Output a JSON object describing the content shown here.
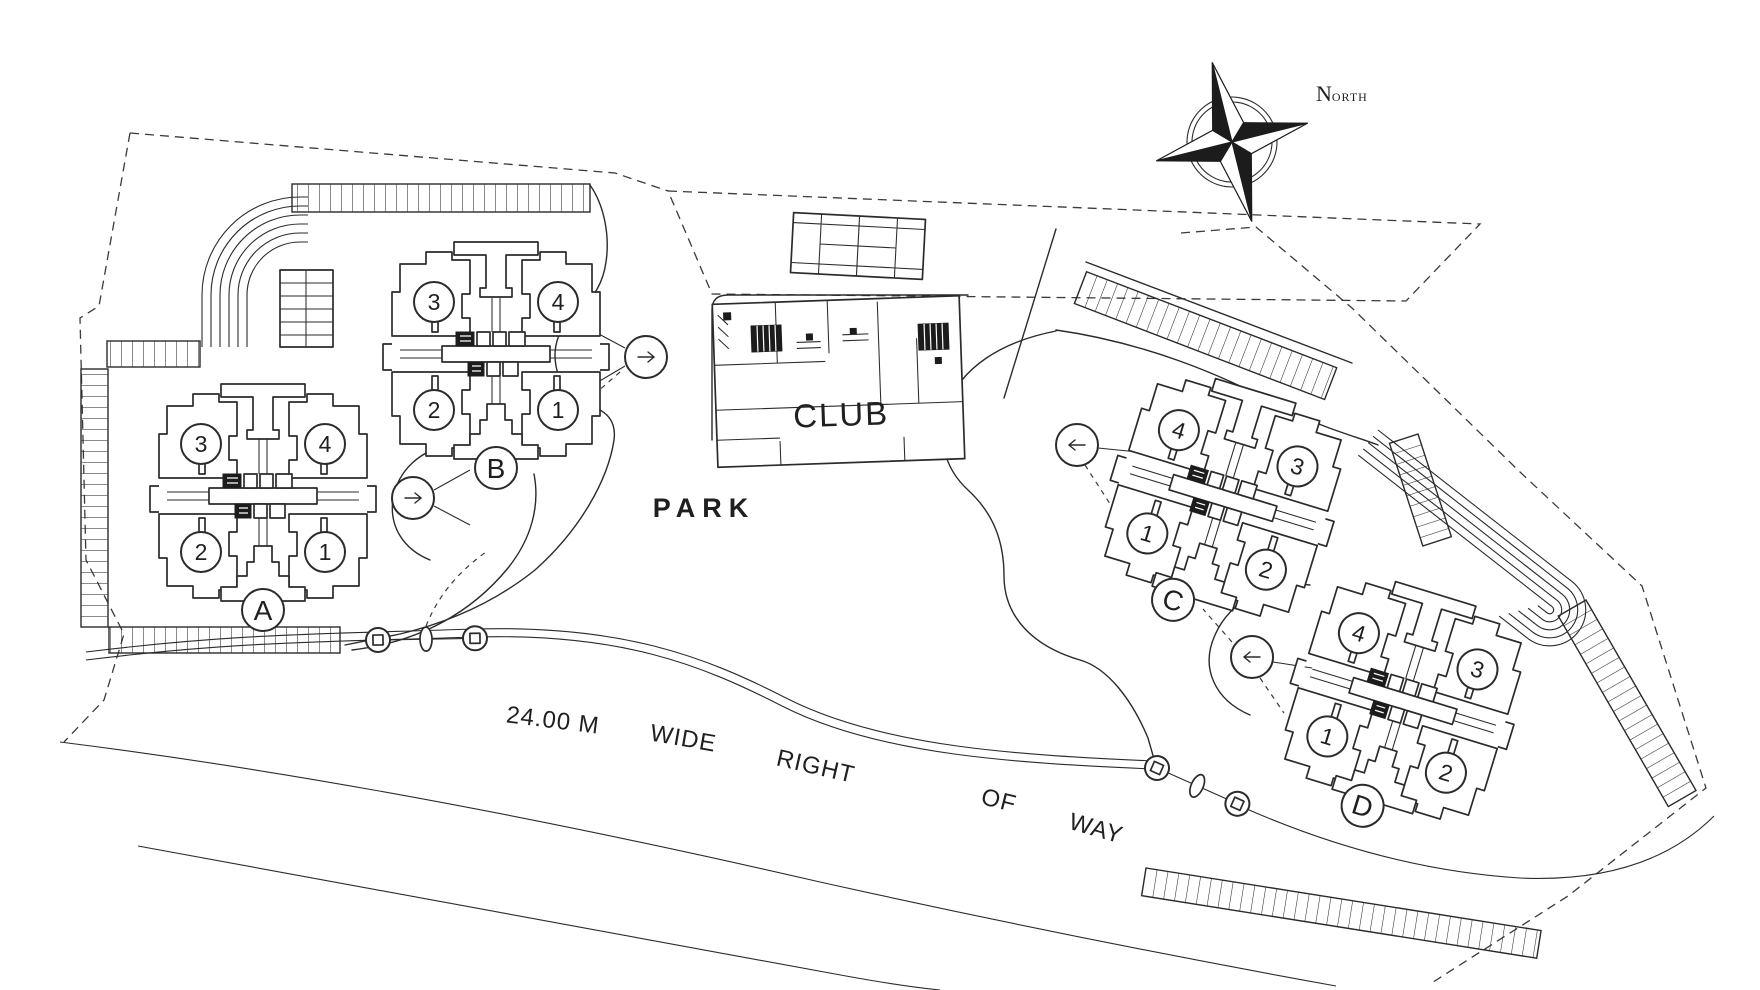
{
  "colors": {
    "paper": "#ffffff",
    "ink": "#2b2b2b",
    "text": "#1f1f1f"
  },
  "compass": {
    "icon": "compass-rose-icon",
    "label_initial": "N",
    "label_rest": "ORTH"
  },
  "labels": {
    "park": "PARK",
    "club": "CLUB"
  },
  "road": {
    "parts": [
      "24.00 M",
      "WIDE",
      "RIGHT",
      "OF",
      "WAY"
    ]
  },
  "buildings": [
    {
      "label": "A",
      "units": [
        "3",
        "4",
        "2",
        "1"
      ]
    },
    {
      "label": "B",
      "units": [
        "3",
        "4",
        "2",
        "1"
      ]
    },
    {
      "label": "C",
      "units": [
        "4",
        "3",
        "1",
        "2"
      ]
    },
    {
      "label": "D",
      "units": [
        "4",
        "3",
        "1",
        "2"
      ]
    }
  ],
  "icons": {
    "compass": "compass-rose-icon",
    "entry": "entry-arrow-icon",
    "gate_post": "gate-post-icon",
    "tennis": "tennis-court-icon"
  }
}
